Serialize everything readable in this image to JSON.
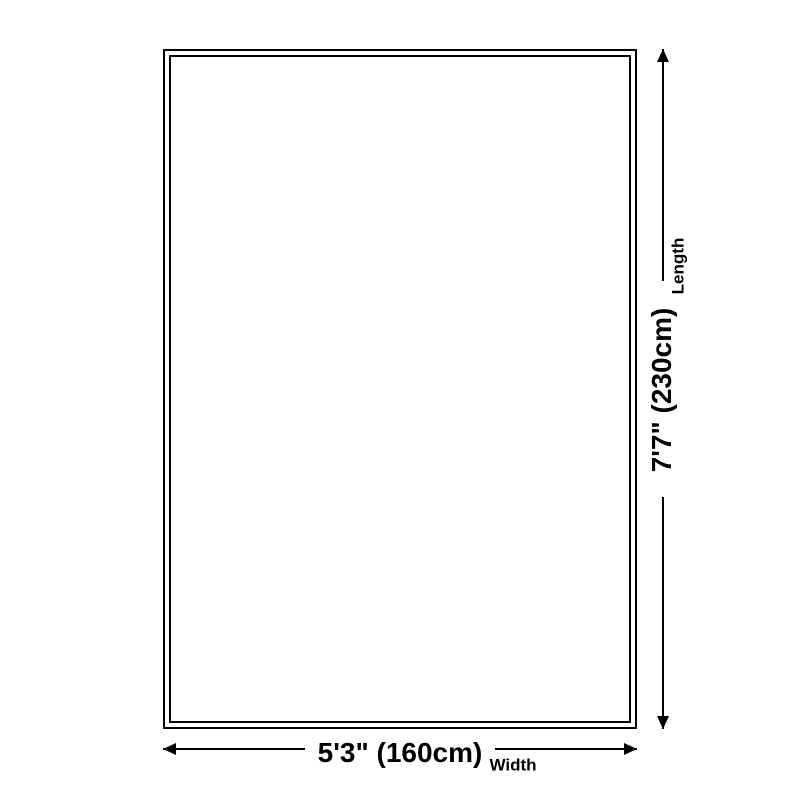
{
  "diagram": {
    "background_color": "#ffffff",
    "line_color": "#000000",
    "product_shape": "rectangle",
    "length": {
      "value": "7'7\" (230cm)",
      "label": "Length"
    },
    "width": {
      "value": "5'3\" (160cm)",
      "label": "Width"
    }
  }
}
